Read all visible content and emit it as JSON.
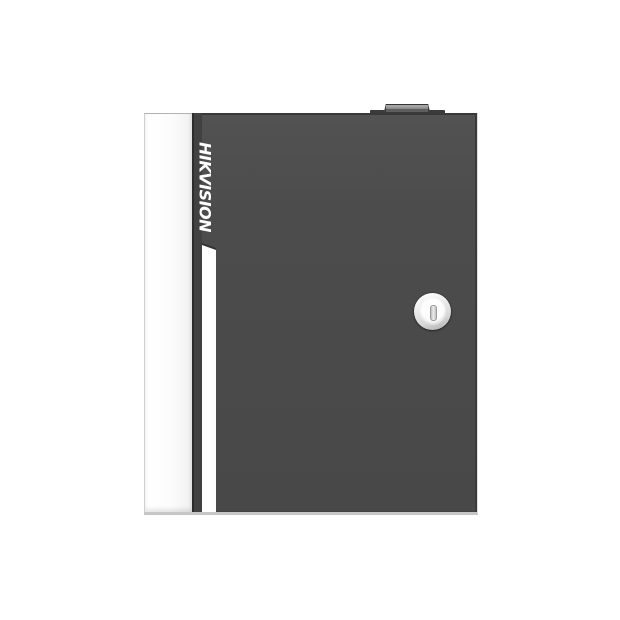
{
  "image": {
    "background_color": "#ffffff",
    "subject": "wall-mount metal enclosure product photo"
  },
  "product": {
    "brand": "HIKVISION",
    "colors": {
      "background": "#ffffff",
      "door": "#4c4c4c",
      "side_panel": "#fcfcfc",
      "accent_stripe": "#fdfdfd",
      "lock_face": "#fdfdfd",
      "brand_text": "#ffffff"
    },
    "parts": {
      "lock": "circular cam lock with vertical keyhole",
      "top_fixture": "small rectangular knob on top edge",
      "stripe": "white vertical accent stripe with slanted top",
      "panel": "white side panel on left edge"
    }
  }
}
